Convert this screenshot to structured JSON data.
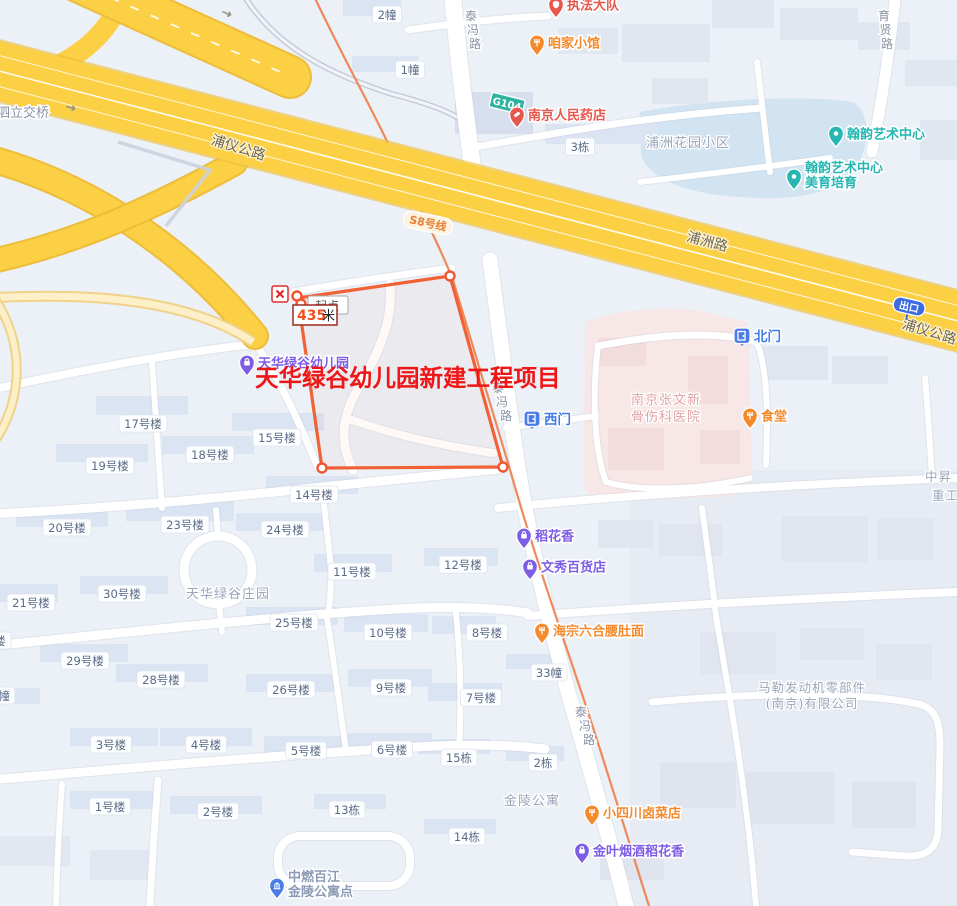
{
  "map": {
    "project": {
      "title": "天华绿谷幼儿园新建工程项目",
      "start_label": "起点",
      "distance_value": "435",
      "distance_unit": "米",
      "title_color": "#ee1616",
      "boundary_color": "#f26136"
    },
    "badges": {
      "g104": "G104",
      "metro": "S8号线",
      "exit": "出口"
    },
    "colors": {
      "highway_fill": "#fcd044",
      "metro_line": "#ef8350",
      "poi_orange": "#f58a2d",
      "poi_purple": "#7d5ce6",
      "poi_red": "#e8574d",
      "poi_teal": "#27b6b2",
      "poi_blue": "#4a7de8"
    },
    "road_labels": [
      {
        "text": "浦泗立交桥",
        "x": -16,
        "y": 117,
        "size": 13,
        "style": "minor",
        "anchor": "start"
      },
      {
        "text": "浦仪公路",
        "x": 237,
        "y": 152,
        "size": 14,
        "style": "highway",
        "rotate": 17
      },
      {
        "text": "浦洲路",
        "x": 706,
        "y": 246,
        "size": 14,
        "style": "highway",
        "rotate": 15
      },
      {
        "text": "浦仪公路",
        "x": 928,
        "y": 336,
        "size": 14,
        "style": "highway",
        "rotate": 17
      },
      {
        "text": "泰冯路",
        "x": 471,
        "y": 20,
        "size": 12,
        "style": "minor",
        "vertical": true,
        "shift": 2
      },
      {
        "text": "泰冯路",
        "x": 498,
        "y": 392,
        "size": 12,
        "style": "minor",
        "vertical": true,
        "shift": 4
      },
      {
        "text": "泰冯路",
        "x": 581,
        "y": 716,
        "size": 12,
        "style": "minor",
        "vertical": true,
        "shift": 4
      },
      {
        "text": "育贤路",
        "x": 884,
        "y": 20,
        "size": 12,
        "style": "minor",
        "vertical": true,
        "shift": 1.5
      }
    ],
    "area_labels": [
      {
        "text": "浦洲花园小区",
        "x": 688,
        "y": 147,
        "size": 13,
        "color": "#9aa6ba"
      },
      {
        "text": "天华绿谷庄园",
        "x": 228,
        "y": 598,
        "size": 13,
        "color": "#9aa6ba"
      },
      {
        "text": "金陵公寓",
        "x": 532,
        "y": 805,
        "size": 13,
        "color": "#9aa6ba"
      },
      {
        "text": "马勒发动机零部件",
        "x": 812,
        "y": 692,
        "size": 12.5,
        "color": "#9aa6ba"
      },
      {
        "text": "(南京)有限公司",
        "x": 812,
        "y": 708,
        "size": 12.5,
        "color": "#9aa6ba"
      },
      {
        "text": "南京张文新",
        "x": 666,
        "y": 404,
        "size": 13,
        "color": "#dfa3a3"
      },
      {
        "text": "骨伤科医院",
        "x": 666,
        "y": 421,
        "size": 13,
        "color": "#dfa3a3"
      },
      {
        "text": "中昇",
        "x": 925,
        "y": 481,
        "size": 12.5,
        "color": "#9aa6ba",
        "anchor": "start"
      },
      {
        "text": "重工",
        "x": 932,
        "y": 500,
        "size": 12.5,
        "color": "#9aa6ba",
        "anchor": "start"
      }
    ],
    "building_labels": [
      {
        "t": "2幢",
        "x": 387,
        "y": 15
      },
      {
        "t": "1幢",
        "x": 410,
        "y": 70
      },
      {
        "t": "3栋",
        "x": 580,
        "y": 147
      },
      {
        "t": "17号楼",
        "x": 143,
        "y": 424
      },
      {
        "t": "15号楼",
        "x": 277,
        "y": 438
      },
      {
        "t": "18号楼",
        "x": 210,
        "y": 455
      },
      {
        "t": "19号楼",
        "x": 110,
        "y": 466
      },
      {
        "t": "14号楼",
        "x": 314,
        "y": 495
      },
      {
        "t": "20号楼",
        "x": 67,
        "y": 528
      },
      {
        "t": "23号楼",
        "x": 185,
        "y": 525
      },
      {
        "t": "24号楼",
        "x": 285,
        "y": 530
      },
      {
        "t": "21号楼",
        "x": 31,
        "y": 603
      },
      {
        "t": "30号楼",
        "x": 122,
        "y": 594
      },
      {
        "t": "25号楼",
        "x": 294,
        "y": 623
      },
      {
        "t": "29号楼",
        "x": 85,
        "y": 661
      },
      {
        "t": "28号楼",
        "x": 161,
        "y": 680
      },
      {
        "t": "26号楼",
        "x": 291,
        "y": 690
      },
      {
        "t": "3号楼",
        "x": 111,
        "y": 745
      },
      {
        "t": "4号楼",
        "x": 206,
        "y": 745
      },
      {
        "t": "5号楼",
        "x": 306,
        "y": 751
      },
      {
        "t": "1号楼",
        "x": 110,
        "y": 807
      },
      {
        "t": "2号楼",
        "x": 218,
        "y": 812
      },
      {
        "t": "10号楼",
        "x": 388,
        "y": 633
      },
      {
        "t": "8号楼",
        "x": 487,
        "y": 633
      },
      {
        "t": "9号楼",
        "x": 391,
        "y": 688
      },
      {
        "t": "7号楼",
        "x": 481,
        "y": 698
      },
      {
        "t": "6号楼",
        "x": 392,
        "y": 750
      },
      {
        "t": "11号楼",
        "x": 352,
        "y": 572
      },
      {
        "t": "12号楼",
        "x": 463,
        "y": 565
      },
      {
        "t": "13栋",
        "x": 347,
        "y": 810
      },
      {
        "t": "14栋",
        "x": 467,
        "y": 837
      },
      {
        "t": "15栋",
        "x": 459,
        "y": 758
      },
      {
        "t": "2栋",
        "x": 543,
        "y": 763
      },
      {
        "t": "33幢",
        "x": 549,
        "y": 673
      },
      {
        "t": "号楼",
        "x": -6,
        "y": 641
      },
      {
        "t": "幢",
        "x": 4,
        "y": 696
      }
    ],
    "pois": [
      {
        "label": "天华绿谷幼儿园",
        "x": 247,
        "y": 376,
        "color": "#7d5ce6",
        "icon": "bag"
      },
      {
        "label": "执法大队",
        "x": 556,
        "y": 18,
        "color": "#e8574d",
        "icon": "shield"
      },
      {
        "label": "咱家小馆",
        "x": 537,
        "y": 56,
        "color": "#f58a2d",
        "icon": "fork"
      },
      {
        "label": "南京人民药店",
        "x": 517,
        "y": 128,
        "color": "#e8574d",
        "icon": "pill"
      },
      {
        "label": "翰韵艺术中心",
        "x": 836,
        "y": 147,
        "color": "#27b6b2",
        "icon": "dot"
      },
      {
        "label": "翰韵艺术中心",
        "label2": "美育培育",
        "x": 794,
        "y": 190,
        "color": "#27b6b2",
        "icon": "dot"
      },
      {
        "label": "食堂",
        "x": 750,
        "y": 429,
        "color": "#f58a2d",
        "icon": "fork"
      },
      {
        "label": "稻花香",
        "x": 524,
        "y": 549,
        "color": "#7d5ce6",
        "icon": "bag"
      },
      {
        "label": "文秀百货店",
        "x": 530,
        "y": 580,
        "color": "#7d5ce6",
        "icon": "bag"
      },
      {
        "label": "海宗六合腰肚面",
        "x": 542,
        "y": 644,
        "color": "#f58a2d",
        "icon": "fork"
      },
      {
        "label": "小四川卤菜店",
        "x": 592,
        "y": 826,
        "color": "#f58a2d",
        "icon": "fork"
      },
      {
        "label": "金叶烟酒稻花香",
        "x": 582,
        "y": 864,
        "color": "#7d5ce6",
        "icon": "bag"
      },
      {
        "label": "中燃百江",
        "label2": "金陵公寓点",
        "x": 277,
        "y": 899,
        "color": "#4a7de8",
        "icon": "bank",
        "label_color": "#8c9bb5"
      }
    ],
    "gates": [
      {
        "label": "北门",
        "x": 742,
        "y": 346
      },
      {
        "label": "西门",
        "x": 532,
        "y": 429
      }
    ]
  }
}
